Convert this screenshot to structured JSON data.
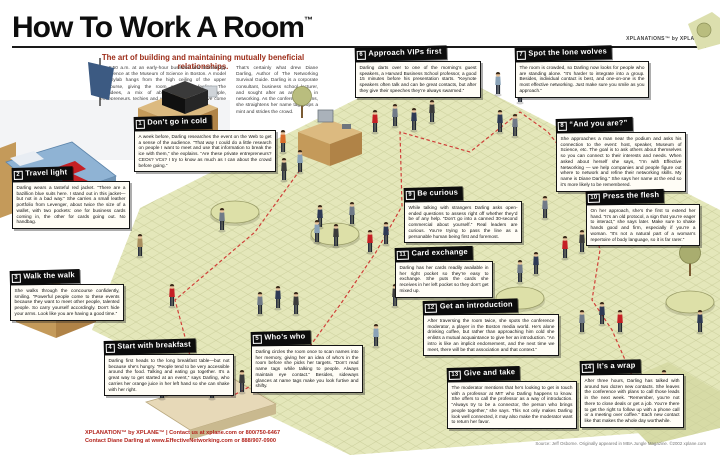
{
  "poster": {
    "title": "How To Work A Room",
    "trademark": "™",
    "subtitle": "The art of building and maintaining mutually beneficial relationships.",
    "logo_top_right": "XPLANATiONS™ by XPLANE®",
    "intro_col1": "It’s 6:50 a.m. at an early-hour business and technology conference at the Museum of Science in Boston. A model of Skylab hangs from the high ceiling of the upper concourse, giving the room a dreamy feeling. The attendees, a mix of about 750 business people, entrepreneurs, techies and venture capitalists, have come to scout clients, investors, or jobs.",
    "intro_col2": "That’s certainly what drew Diane Darling, Author of The Networking Survival Guide. Darling is a corporate consultant, business school lecturer, and sought after as an expert in networking. As the conference begins, she straightens her name tag, pops a mint and strides the crowd.",
    "accent_color": "#9c2c18"
  },
  "sections": [
    {
      "number": "1",
      "title": "Don’t go in cold",
      "body": "A week before, Darling researches the event on the Web to get a sense of the audience. “That way I could do a little research on people I want to meet and use that information to break the ice with them,” she explains. “Are these private entrepreneurs? CEOs? VCs? I try to know as much as I can about the crowd before going.”"
    },
    {
      "number": "2",
      "title": "Travel light",
      "body": "Darling wears a tasteful red jacket. “There are a bazillion blue suits here. I stand out in this jacket—but not in a bad way.” She carries a small leather portfolio from Levenger, about twice the size of a wallet, with two pockets: one for business cards coming in, the other for cards going out. No handbag."
    },
    {
      "number": "3",
      "title": "Walk the walk",
      "body": "She walks through the concourse confidently, smiling. “Powerful people come to these events because they want to meet other people, talented people. So carry yourself accordingly. Don’t hide your arms. Look like you are having a good time.”"
    },
    {
      "number": "4",
      "title": "Start with breakfast",
      "body": "Darling first heads to the long breakfast table—but not because she’s hungry. “People tend to be very accessible around the food. Talking and eating go together. It’s a great way to get started at an event,” says Darling, who carries her orange juice in her left hand so she can shake with her right."
    },
    {
      "number": "5",
      "title": "Who’s who",
      "body": "Darling circles the room once to scan names into her memory, giving her an idea of who’s in the room before she picks her targets. “Don’t read name tags while talking to people. Always maintain eye contact.” Besides, sideways glances at name tags make you look furtive and shifty."
    },
    {
      "number": "6",
      "title": "Approach VIPs first",
      "body": "Darling darts over to one of the morning’s guest speakers, a Harvard Business School professor, a good 15 minutes before his presentation starts. “Keynote speakers often talk and can be great contacts, but after they give their speeches they’re always swarmed.”"
    },
    {
      "number": "7",
      "title": "Spot the lone wolves",
      "body": "The room is crowded, so Darling now looks for people who are standing alone. “It’s harder to integrate into a group. Besides, individual contact is best, and one-on-one is the most effective networking. Just make sure you smile as you approach.”"
    },
    {
      "number": "8",
      "title": "“And you are?”",
      "body": "She approaches a man near the podium and asks his connection to the event: host, speaker, Museum of Science, etc. The goal is to ask others about themselves so you can connect to their interests and needs. When asked about herself she says, “I’m with Effective Networking — we help companies and people figure out where to network and refine their networking skills. My name is Diane Darling.” She says her name at the end so it’s more likely to be remembered."
    },
    {
      "number": "9",
      "title": "Be curious",
      "body": "While talking with strangers Darling asks open-ended questions to assess right off whether they’d be of any help. “Don’t go into a canned 30-second commercial about yourself.” Real leaders are curious. You’re trying to pass the line as a personable human being first and foremost."
    },
    {
      "number": "10",
      "title": "Press the flesh",
      "body": "On her approach, she’s the first to extend her hand. “It’s an old protocol, a sign that you’re eager to interact,” she says later. Make sure to shake hands good and firm, especially if you’re a woman. “It’s not a natural part of a woman’s repertoire of body language, so it is far rarer.”"
    },
    {
      "number": "11",
      "title": "Card exchange",
      "body": "Darling has her cards readily available in her right pocket so they’re easy to exchange. She puts the cards she receives in her left pocket so they don’t get mixed up."
    },
    {
      "number": "12",
      "title": "Get an introduction",
      "body": "After traversing the room twice, she spots the conference moderator, a player in the Boston media world. He’s alone drinking coffee, but rather than approaching him cold she enlists a mutual acquaintance to give her an introduction. “An intro is like an implicit endorsement, and the next time we meet, there will be that association and that context.”"
    },
    {
      "number": "13",
      "title": "Give and take",
      "body": "The moderator mentions that he’s looking to get in touch with a professor at MIT who Darling happens to know. She offers to call the professor as a way of introduction. “Always try to be a connector, the person who brings people together,” she says. This not only makes Darling look well connected, it may also make the moderator want to return her favor."
    },
    {
      "number": "14",
      "title": "It’s a wrap",
      "body": "After three hours, Darling has talked with around two dozen new contacts. She leaves the conference with plans to call those leads in the next week. “Remember, you’re not there to close deals or get a job. You’re there to get the right to follow up with a phone call or a meeting over coffee.” Each new contact like that makes the whole day worthwhile."
    }
  ],
  "footer": {
    "line1": "XPLANATION™ by XPLANE™ | Contact us at xplane.com or 800/750-6467",
    "line2": "Contact Diane Darling at www.EffectiveNetworking.com or 888/907-0900",
    "credit": "Source: Jeff Osborne. Originally appeared in MBA Jungle Magazine. ©2002 xplane.com"
  }
}
